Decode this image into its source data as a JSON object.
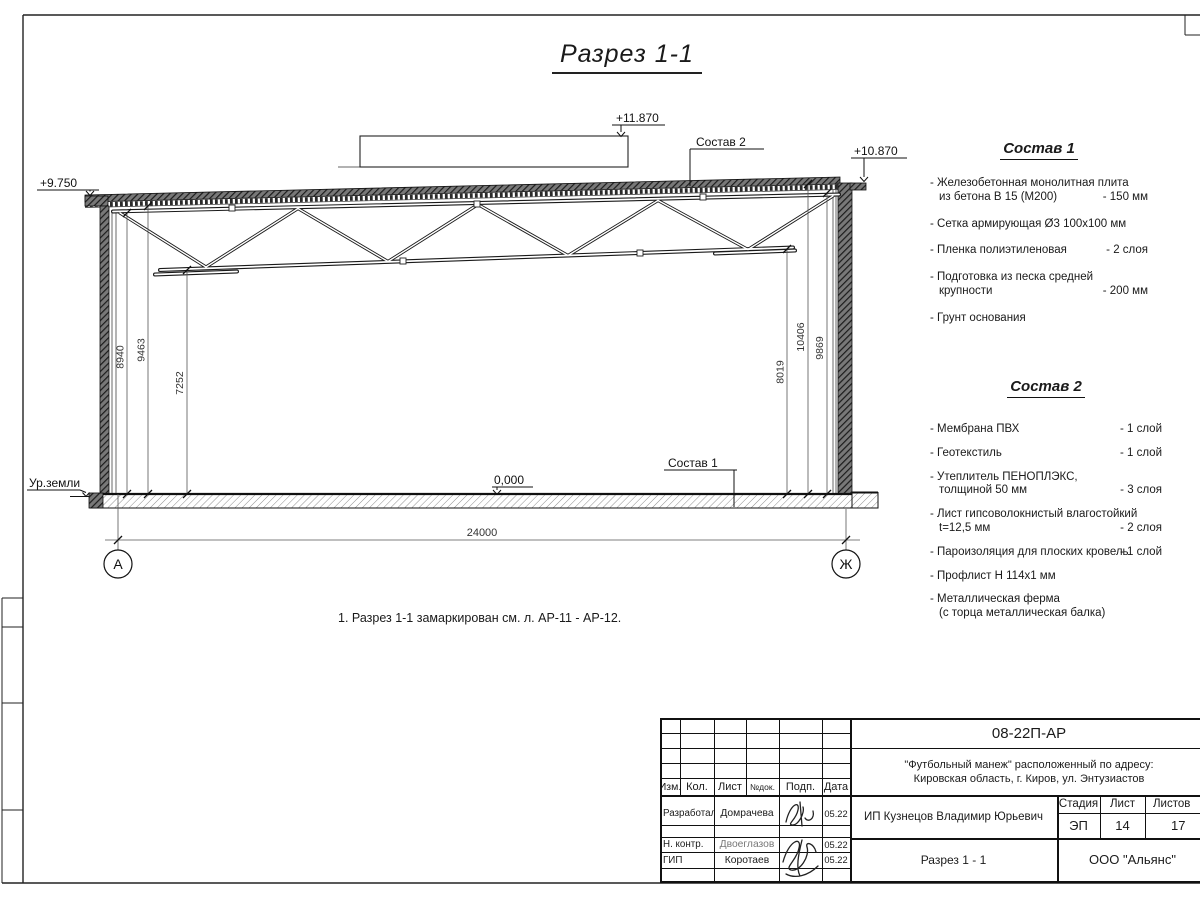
{
  "page": {
    "title": "Разрез 1-1",
    "note": "1. Разрез 1-1 замаркирован см. л. АР-11 - АР-12."
  },
  "drawing": {
    "elev_left": "+9.750",
    "elev_box": "+11.870",
    "elev_right": "+10.870",
    "elev_floor": "0,000",
    "ground_label": "Ур.земли",
    "leader_sostav1": "Состав 1",
    "leader_sostav2": "Состав 2",
    "dims_left": [
      "8940",
      "9463",
      "7252"
    ],
    "dims_right": [
      "8019",
      "10406",
      "9869"
    ],
    "dim_span": "24000",
    "axis_left": "А",
    "axis_right": "Ж"
  },
  "sostav1": {
    "title": "Состав 1",
    "items": [
      {
        "line1": "- Железобетонная  монолитная плита",
        "line2": "из бетона В 15 (М200)",
        "qty": "- 150 мм"
      },
      {
        "line1": "- Сетка армирующая Ø3 100х100 мм"
      },
      {
        "line1": "- Пленка полиэтиленовая",
        "qty": "-  2 слоя"
      },
      {
        "line1": "- Подготовка из песка средней",
        "line2": "крупности",
        "qty": "- 200 мм"
      },
      {
        "line1": "- Грунт основания"
      }
    ]
  },
  "sostav2": {
    "title": "Состав 2",
    "items": [
      {
        "line1": "- Мембрана ПВХ",
        "qty": "- 1 слой"
      },
      {
        "line1": "- Геотекстиль",
        "qty": "- 1 слой"
      },
      {
        "line1": "- Утеплитель ПЕНОПЛЭКС,",
        "line2": "толщиной 50 мм",
        "qty": "- 3 слоя"
      },
      {
        "line1": "- Лист гипсоволокнистый влагостойкий",
        "line2": "t=12,5 мм",
        "qty": "- 2 слоя"
      },
      {
        "line1": "- Пароизоляция для плоских кровель",
        "qty": "- 1 слой"
      },
      {
        "line1": "- Профлист Н 114х1 мм"
      },
      {
        "line1": "- Металлическая ферма",
        "line2": "(с торца металлическая балка)"
      }
    ]
  },
  "titleblock": {
    "doc_number": "08-22П-АР",
    "project_line1": "\"Футбольный манеж\" расположенный по адресу:",
    "project_line2": "Кировская область, г. Киров, ул. Энтузиастов",
    "client": "ИП Кузнецов Владимир Юрьевич",
    "sheet_title": "Разрез 1 - 1",
    "company": "ООО \"Альянс\"",
    "col_izm": "Изм.",
    "col_kol": "Кол.",
    "col_list": "Лист",
    "col_ndok": "№док.",
    "col_podp": "Подп.",
    "col_data": "Дата",
    "col_stadia": "Стадия",
    "col_sheet": "Лист",
    "col_sheets": "Листов",
    "stadia": "ЭП",
    "sheet_no": "14",
    "sheets_total": "17",
    "rows": [
      {
        "role": "Разработал",
        "name": "Домрачева",
        "date": "05.22"
      },
      {
        "role": "Н. контр.",
        "name": "Двоеглазов",
        "date": "05.22"
      },
      {
        "role": "ГИП",
        "name": "Коротаев",
        "date": "05.22"
      }
    ]
  }
}
